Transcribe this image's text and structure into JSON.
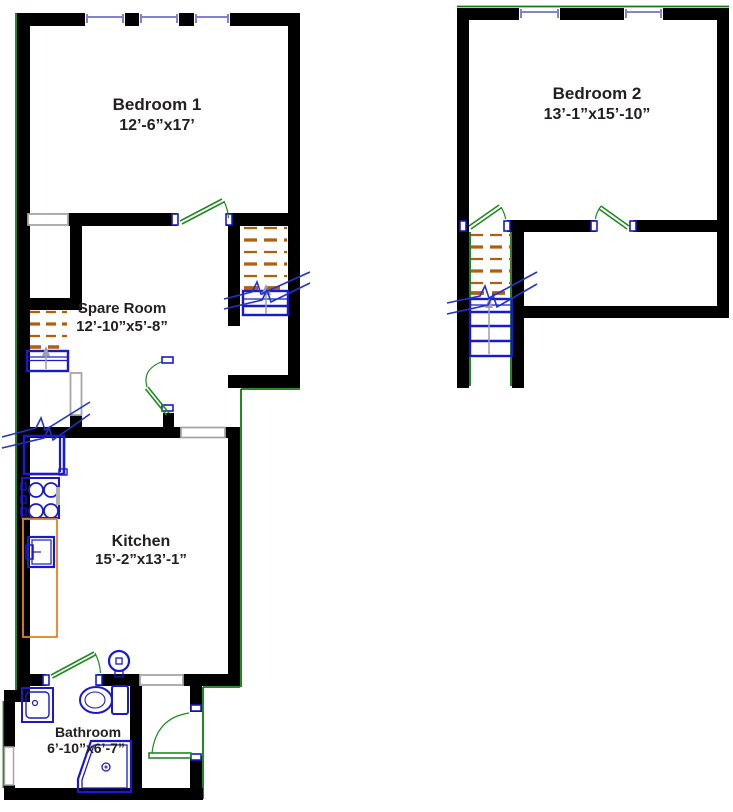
{
  "title": "Two-level apartment floor plan",
  "colors": {
    "wall": "#000000",
    "exterior": "#0a7c0a",
    "door": "#1f8a1f",
    "fixture": "#1a1acc",
    "stair_upper": "#b05f10",
    "stair_lower": "#1a1acc",
    "break_line": "#2233cc",
    "counter": "#e8821e",
    "opening": "#a6a6a6",
    "window": "#8084cf",
    "arrow": "#9aa0a8",
    "text": "#231f20"
  },
  "rooms": {
    "bedroom1": {
      "name": "Bedroom 1",
      "dims": "12’-6”x17’"
    },
    "spare_room": {
      "name": "Spare Room",
      "dims": "12’-10”x5’-8”"
    },
    "kitchen": {
      "name": "Kitchen",
      "dims": "15’-2”x13’-1”"
    },
    "bathroom": {
      "name": "Bathroom",
      "dims": "6’-10”x6’-7”"
    },
    "bedroom2": {
      "name": "Bedroom 2",
      "dims": "13’-1”x15’-10”"
    }
  }
}
